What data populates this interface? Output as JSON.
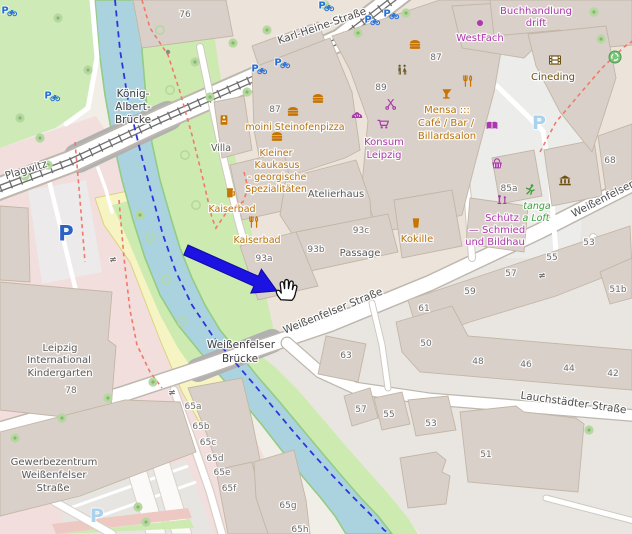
{
  "app": {
    "type": "map-viewer",
    "description": "OpenStreetMap slippy-map screenshot with click-target annotation"
  },
  "annotation": {
    "arrow": {
      "color": "#1c13e2",
      "tail": {
        "x": 186,
        "y": 250
      },
      "tip": {
        "x": 277,
        "y": 291
      }
    },
    "cursor": {
      "type": "open-hand",
      "x": 285,
      "y": 292
    }
  },
  "palette": {
    "water": "#abd3df",
    "grass_bank": "#cdebb0",
    "park": "#cdeab7",
    "building": "#d9d0c9",
    "road": "#ffffff",
    "land_tan": "#ece3da",
    "land_gray": "#e9e6e2",
    "land_pink": "#f2dedd",
    "allotment_yellow": "#f7f4c4",
    "tram": "#6f6f6f",
    "route_blue": "#2b36dd",
    "route_red": "#f07a6a",
    "amenity_text": "#b8740e",
    "shop_text": "#ac39ac",
    "tourism_text": "#6d5113",
    "leisure_text": "#3fa03f",
    "street_text": "#4e4e4e",
    "housenumber_text": "#6e6e6e",
    "parking_blue": "#2a62c4",
    "parking_faded": "#a9d2ec",
    "bike_parking_blue": "#2470d8"
  },
  "map": {
    "labels": [
      {
        "t": "Karl-Heine-Straße",
        "x": 323,
        "y": 29,
        "s": 10.5,
        "c": "#4e4e4e",
        "r": -19
      },
      {
        "t": "Plagwitz",
        "x": 27,
        "y": 173,
        "s": 10.5,
        "c": "#555555",
        "r": -17
      },
      {
        "t": "König-",
        "x": 133,
        "y": 97,
        "s": 10.5,
        "c": "#3e3e3e"
      },
      {
        "t": "Albert-",
        "x": 133,
        "y": 110,
        "s": 10.5,
        "c": "#3e3e3e"
      },
      {
        "t": "Brücke",
        "x": 133,
        "y": 123,
        "s": 10.5,
        "c": "#3e3e3e"
      },
      {
        "t": "Weißenfelser",
        "x": 241,
        "y": 348,
        "s": 10.5,
        "c": "#3e3e3e"
      },
      {
        "t": "Brücke",
        "x": 240,
        "y": 362,
        "s": 10.5,
        "c": "#3e3e3e"
      },
      {
        "t": "Weißenfelser Straße",
        "x": 334,
        "y": 314,
        "s": 10.5,
        "c": "#4e4e4e",
        "r": -22
      },
      {
        "t": "Weißenfelser",
        "x": 604,
        "y": 202,
        "s": 10.5,
        "c": "#4e4e4e",
        "r": -27
      },
      {
        "t": "Lauchstädter Straße",
        "x": 573,
        "y": 406,
        "s": 10.5,
        "c": "#4e4e4e",
        "r": 8
      },
      {
        "t": "76",
        "x": 185,
        "y": 17,
        "s": 9,
        "c": "#6e6e6e"
      },
      {
        "t": "87",
        "x": 275,
        "y": 112,
        "s": 9,
        "c": "#6e6e6e"
      },
      {
        "t": "87",
        "x": 436,
        "y": 60,
        "s": 9,
        "c": "#6e6e6e"
      },
      {
        "t": "89",
        "x": 381,
        "y": 90,
        "s": 9,
        "c": "#6e6e6e"
      },
      {
        "t": "68",
        "x": 610,
        "y": 163,
        "s": 9,
        "c": "#6e6e6e"
      },
      {
        "t": "85a",
        "x": 509,
        "y": 191,
        "s": 9,
        "c": "#6e6e6e"
      },
      {
        "t": "93a",
        "x": 264,
        "y": 261,
        "s": 9,
        "c": "#6e6e6e"
      },
      {
        "t": "93b",
        "x": 316,
        "y": 252,
        "s": 9,
        "c": "#6e6e6e"
      },
      {
        "t": "93c",
        "x": 361,
        "y": 233,
        "s": 9,
        "c": "#6e6e6e"
      },
      {
        "t": "51b",
        "x": 618,
        "y": 292,
        "s": 9,
        "c": "#6e6e6e"
      },
      {
        "t": "61",
        "x": 424,
        "y": 311,
        "s": 9,
        "c": "#6e6e6e"
      },
      {
        "t": "59",
        "x": 470,
        "y": 294,
        "s": 9,
        "c": "#6e6e6e"
      },
      {
        "t": "57",
        "x": 511,
        "y": 276,
        "s": 9,
        "c": "#6e6e6e"
      },
      {
        "t": "55",
        "x": 552,
        "y": 260,
        "s": 9,
        "c": "#6e6e6e"
      },
      {
        "t": "53",
        "x": 589,
        "y": 245,
        "s": 9,
        "c": "#6e6e6e"
      },
      {
        "t": "63",
        "x": 346,
        "y": 358,
        "s": 9,
        "c": "#6e6e6e"
      },
      {
        "t": "50",
        "x": 426,
        "y": 346,
        "s": 9,
        "c": "#6e6e6e"
      },
      {
        "t": "48",
        "x": 478,
        "y": 364,
        "s": 9,
        "c": "#6e6e6e"
      },
      {
        "t": "46",
        "x": 526,
        "y": 367,
        "s": 9,
        "c": "#6e6e6e"
      },
      {
        "t": "44",
        "x": 569,
        "y": 371,
        "s": 9,
        "c": "#6e6e6e"
      },
      {
        "t": "42",
        "x": 613,
        "y": 376,
        "s": 9,
        "c": "#6e6e6e"
      },
      {
        "t": "57",
        "x": 361,
        "y": 412,
        "s": 9,
        "c": "#6e6e6e"
      },
      {
        "t": "55",
        "x": 389,
        "y": 417,
        "s": 9,
        "c": "#6e6e6e"
      },
      {
        "t": "53",
        "x": 431,
        "y": 426,
        "s": 9,
        "c": "#6e6e6e"
      },
      {
        "t": "51",
        "x": 486,
        "y": 457,
        "s": 9,
        "c": "#6e6e6e"
      },
      {
        "t": "78",
        "x": 71,
        "y": 393,
        "s": 9,
        "c": "#6e6e6e"
      },
      {
        "t": "65a",
        "x": 193,
        "y": 409,
        "s": 9,
        "c": "#6e6e6e"
      },
      {
        "t": "65b",
        "x": 201,
        "y": 429,
        "s": 9,
        "c": "#6e6e6e"
      },
      {
        "t": "65c",
        "x": 208,
        "y": 445,
        "s": 9,
        "c": "#6e6e6e"
      },
      {
        "t": "65d",
        "x": 215,
        "y": 461,
        "s": 9,
        "c": "#6e6e6e"
      },
      {
        "t": "65e",
        "x": 222,
        "y": 475,
        "s": 9,
        "c": "#6e6e6e"
      },
      {
        "t": "65f",
        "x": 229,
        "y": 491,
        "s": 9,
        "c": "#6e6e6e"
      },
      {
        "t": "65g",
        "x": 288,
        "y": 508,
        "s": 9,
        "c": "#6e6e6e"
      },
      {
        "t": "65h",
        "x": 300,
        "y": 532,
        "s": 9,
        "c": "#6e6e6e"
      },
      {
        "t": "Villa",
        "x": 221,
        "y": 151,
        "s": 9.5,
        "c": "#5a5a5a"
      },
      {
        "t": "Atelierhaus",
        "x": 336,
        "y": 197,
        "s": 10,
        "c": "#5a5a5a"
      },
      {
        "t": "Passage",
        "x": 360,
        "y": 256,
        "s": 10,
        "c": "#5a5a5a"
      },
      {
        "t": "moini Steinofenpizza",
        "x": 295,
        "y": 130,
        "s": 9.5,
        "c": "#b8740e"
      },
      {
        "t": "Kleiner",
        "x": 276,
        "y": 156,
        "s": 9.5,
        "c": "#b8740e"
      },
      {
        "t": "Kaukasus",
        "x": 277,
        "y": 168,
        "s": 9.5,
        "c": "#b8740e"
      },
      {
        "t": "- georgische",
        "x": 277,
        "y": 180,
        "s": 9.5,
        "c": "#b8740e"
      },
      {
        "t": "Spezialitäten",
        "x": 276,
        "y": 192,
        "s": 9.5,
        "c": "#b8740e"
      },
      {
        "t": "Kaiserbad",
        "x": 232,
        "y": 212,
        "s": 9.5,
        "c": "#b8740e"
      },
      {
        "t": "Kaiserbad",
        "x": 257,
        "y": 243,
        "s": 9.5,
        "c": "#b8740e"
      },
      {
        "t": "Konsum",
        "x": 384,
        "y": 145,
        "s": 10,
        "c": "#ac39ac"
      },
      {
        "t": "Leipzig",
        "x": 384,
        "y": 158,
        "s": 10,
        "c": "#ac39ac"
      },
      {
        "t": "Mensa :::",
        "x": 447,
        "y": 113,
        "s": 10,
        "c": "#b8740e"
      },
      {
        "t": "Café / Bar /",
        "x": 446,
        "y": 126,
        "s": 10,
        "c": "#b8740e"
      },
      {
        "t": "Billardsalon",
        "x": 447,
        "y": 139,
        "s": 10,
        "c": "#b8740e"
      },
      {
        "t": "Kokille",
        "x": 417,
        "y": 242,
        "s": 10,
        "c": "#b8740e"
      },
      {
        "t": "WestFach",
        "x": 480,
        "y": 41,
        "s": 10,
        "c": "#ac39ac"
      },
      {
        "t": "Buchhandlung",
        "x": 536,
        "y": 14,
        "s": 10,
        "c": "#ac39ac"
      },
      {
        "t": "drift",
        "x": 536,
        "y": 26,
        "s": 10,
        "c": "#ac39ac"
      },
      {
        "t": "Cineding",
        "x": 553,
        "y": 80,
        "s": 10,
        "c": "#6d5113"
      },
      {
        "t": "tanga",
        "x": 537,
        "y": 209,
        "s": 9.5,
        "c": "#3fa03f",
        "i": 1
      },
      {
        "t": "a Loft",
        "x": 536,
        "y": 221,
        "s": 9.5,
        "c": "#3fa03f",
        "i": 1
      },
      {
        "t": "Schütz",
        "x": 502,
        "y": 221,
        "s": 10,
        "c": "#ac39ac"
      },
      {
        "t": "— Schmied",
        "x": 497,
        "y": 233,
        "s": 10,
        "c": "#ac39ac"
      },
      {
        "t": "und Bildhau",
        "x": 495,
        "y": 245,
        "s": 10,
        "c": "#ac39ac"
      },
      {
        "t": "Leipzig",
        "x": 60,
        "y": 351,
        "s": 10,
        "c": "#5a5a5a"
      },
      {
        "t": "International",
        "x": 59,
        "y": 363,
        "s": 10,
        "c": "#5a5a5a"
      },
      {
        "t": "Kindergarten",
        "x": 60,
        "y": 376,
        "s": 10,
        "c": "#5a5a5a"
      },
      {
        "t": "Gewerbezentrum",
        "x": 54,
        "y": 465,
        "s": 10,
        "c": "#5a5a5a"
      },
      {
        "t": "Weißenfelser",
        "x": 54,
        "y": 478,
        "s": 10,
        "c": "#5a5a5a"
      },
      {
        "t": "Straße",
        "x": 53,
        "y": 491,
        "s": 10,
        "c": "#5a5a5a"
      }
    ],
    "icons": [
      {
        "type": "fast-food",
        "x": 415,
        "y": 45
      },
      {
        "type": "fast-food",
        "x": 318,
        "y": 99
      },
      {
        "type": "fast-food",
        "x": 293,
        "y": 112
      },
      {
        "type": "fast-food",
        "x": 277,
        "y": 137
      },
      {
        "type": "toilets",
        "x": 402,
        "y": 70
      },
      {
        "type": "bar",
        "x": 447,
        "y": 94
      },
      {
        "type": "restaurant",
        "x": 468,
        "y": 81
      },
      {
        "type": "restaurant",
        "x": 254,
        "y": 222
      },
      {
        "type": "biergarten",
        "x": 231,
        "y": 193
      },
      {
        "type": "pub",
        "x": 416,
        "y": 223
      },
      {
        "type": "books",
        "x": 492,
        "y": 126
      },
      {
        "type": "convenience-basket",
        "x": 497,
        "y": 164
      },
      {
        "type": "supermarket-cart",
        "x": 383,
        "y": 124
      },
      {
        "type": "bakery",
        "x": 357,
        "y": 116
      },
      {
        "type": "hairdresser",
        "x": 391,
        "y": 104
      },
      {
        "type": "vending-machine",
        "x": 224,
        "y": 120
      },
      {
        "type": "cinema",
        "x": 555,
        "y": 60
      },
      {
        "type": "museum",
        "x": 565,
        "y": 181
      },
      {
        "type": "artwork",
        "x": 502,
        "y": 200
      },
      {
        "type": "fitness-runner",
        "x": 530,
        "y": 190
      },
      {
        "type": "recycling",
        "x": 615,
        "y": 57
      },
      {
        "type": "bicycle-shop",
        "x": 424,
        "y": 196
      },
      {
        "type": "bicycle-parking",
        "x": 48,
        "y": 95,
        "glyph": "P",
        "c": "#2470d8",
        "s": 10
      },
      {
        "type": "bicycle-parking",
        "x": 255,
        "y": 68,
        "glyph": "P",
        "c": "#2470d8",
        "s": 10
      },
      {
        "type": "bicycle-parking",
        "x": 278,
        "y": 62,
        "glyph": "P",
        "c": "#2470d8",
        "s": 10
      },
      {
        "type": "bicycle-parking",
        "x": 368,
        "y": 19,
        "glyph": "P",
        "c": "#2470d8",
        "s": 10
      },
      {
        "type": "bicycle-parking",
        "x": 387,
        "y": 13,
        "glyph": "P",
        "c": "#2470d8",
        "s": 10
      },
      {
        "type": "bicycle-parking",
        "x": 322,
        "y": 5,
        "glyph": "P",
        "c": "#2470d8",
        "s": 10
      },
      {
        "type": "bicycle-parking",
        "x": 5,
        "y": 10,
        "glyph": "P",
        "c": "#2470d8",
        "s": 10
      },
      {
        "type": "parking",
        "x": 66,
        "y": 233,
        "glyph": "P",
        "c": "#2a62c4",
        "s": 21
      },
      {
        "type": "parking-faded",
        "x": 539,
        "y": 122,
        "glyph": "P",
        "c": "#a9d2ec",
        "s": 19
      },
      {
        "type": "parking-faded",
        "x": 97,
        "y": 515,
        "glyph": "P",
        "c": "#a9d2ec",
        "s": 19
      },
      {
        "type": "poi-dot",
        "x": 480,
        "y": 23
      },
      {
        "type": "node-dot",
        "x": 168,
        "y": 52
      },
      {
        "type": "gate",
        "x": 113,
        "y": 259,
        "glyph": "≠",
        "c": "#777777",
        "s": 9
      },
      {
        "type": "gate",
        "x": 172,
        "y": 392,
        "glyph": "≠",
        "c": "#777777",
        "s": 9
      },
      {
        "type": "gate",
        "x": 542,
        "y": 275,
        "glyph": "≠",
        "c": "#777777",
        "s": 9
      }
    ],
    "trees": {
      "solid": [
        [
          58,
          18
        ],
        [
          88,
          70
        ],
        [
          20,
          118
        ],
        [
          40,
          138
        ],
        [
          195,
          62
        ],
        [
          233,
          43
        ],
        [
          267,
          30
        ],
        [
          325,
          5
        ],
        [
          358,
          33
        ],
        [
          210,
          97
        ],
        [
          247,
          92
        ],
        [
          406,
          13
        ],
        [
          594,
          12
        ],
        [
          601,
          39
        ],
        [
          48,
          165
        ],
        [
          25,
          176
        ],
        [
          140,
          215
        ],
        [
          108,
          398
        ],
        [
          62,
          418
        ],
        [
          15,
          438
        ],
        [
          153,
          382
        ],
        [
          138,
          507
        ],
        [
          146,
          522
        ],
        [
          589,
          430
        ]
      ],
      "ring": [
        [
          150,
          238
        ],
        [
          166,
          280
        ],
        [
          182,
          322
        ],
        [
          160,
          30
        ],
        [
          170,
          90
        ],
        [
          185,
          155
        ],
        [
          196,
          205
        ]
      ]
    }
  }
}
